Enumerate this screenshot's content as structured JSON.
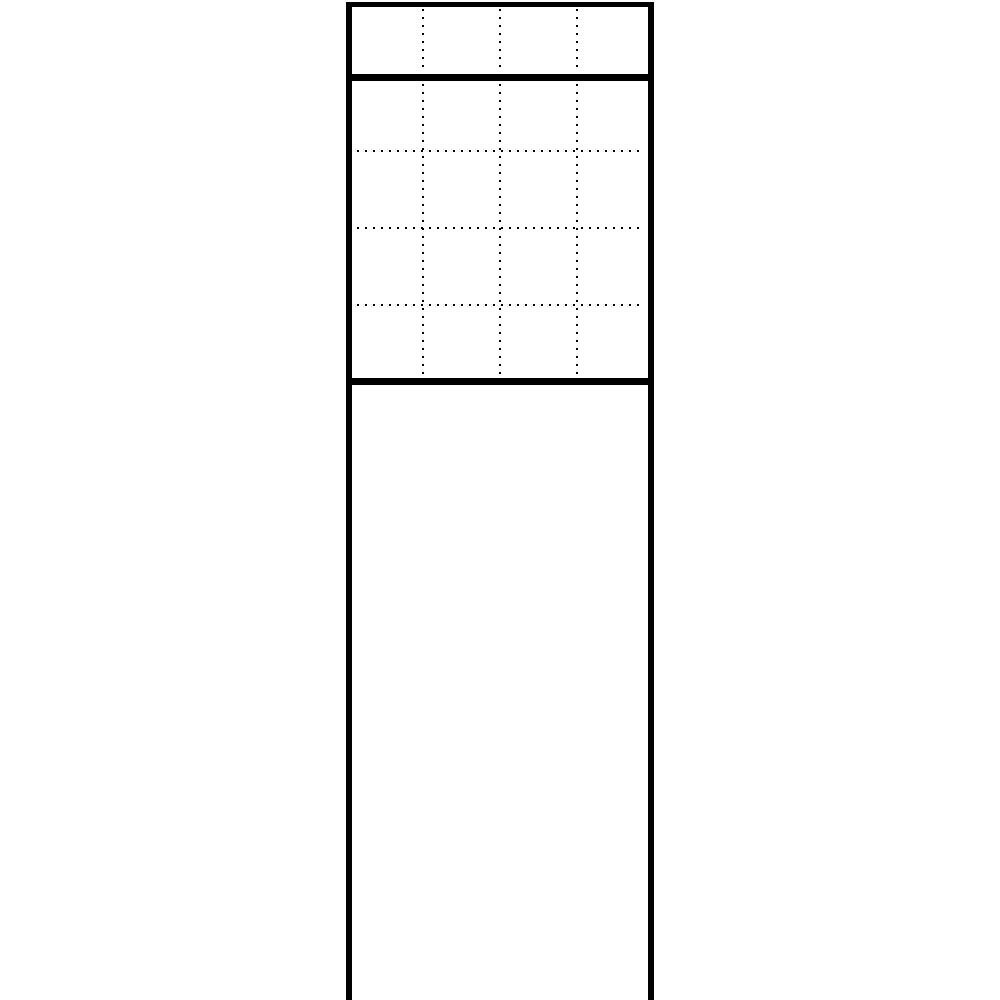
{
  "figure": {
    "description": "Monochrome technical line drawing of a modular free-standing panel column: one top module band, a 4x4 dotted module grid between two thick separator lines, and a long open-bottom support post",
    "background_color": "#ffffff",
    "line_color": "#000000",
    "canvas": {
      "width": 1000,
      "height": 1000
    },
    "column": {
      "outer_left": 346,
      "outer_right": 654,
      "outer_width": 308,
      "side_line_width": 6,
      "top": 2,
      "bottom": 1000,
      "bottom_closed": false
    },
    "solid_lines": {
      "left_side": {
        "x": 346,
        "y": 2,
        "w": 6,
        "h": 998
      },
      "right_side": {
        "x": 648,
        "y": 2,
        "w": 6,
        "h": 998
      },
      "top_border": {
        "x": 346,
        "y": 2,
        "w": 308,
        "h": 5
      },
      "separator_upper": {
        "x": 346,
        "y": 74,
        "w": 308,
        "h": 7
      },
      "separator_lower": {
        "x": 346,
        "y": 378,
        "w": 308,
        "h": 7
      }
    },
    "dotted_lines": {
      "dot_size": 2,
      "dot_pitch": 8,
      "vertical_x_centers": [
        423,
        500,
        577
      ],
      "top_band_segment": {
        "y1": 9,
        "y2": 73
      },
      "grid_band_segment": {
        "y1": 84,
        "y2": 377
      },
      "horizontal_y_centers": [
        151,
        228,
        305
      ],
      "horizontal_x1": 357,
      "horizontal_x2": 644
    },
    "sections": [
      {
        "name": "top-module-row",
        "rows": 1,
        "cols": 4,
        "cell_size": 77
      },
      {
        "name": "main-module-grid",
        "rows": 4,
        "cols": 4,
        "cell_size": 77
      },
      {
        "name": "support-post",
        "rows": 0,
        "cols": 0
      }
    ]
  }
}
